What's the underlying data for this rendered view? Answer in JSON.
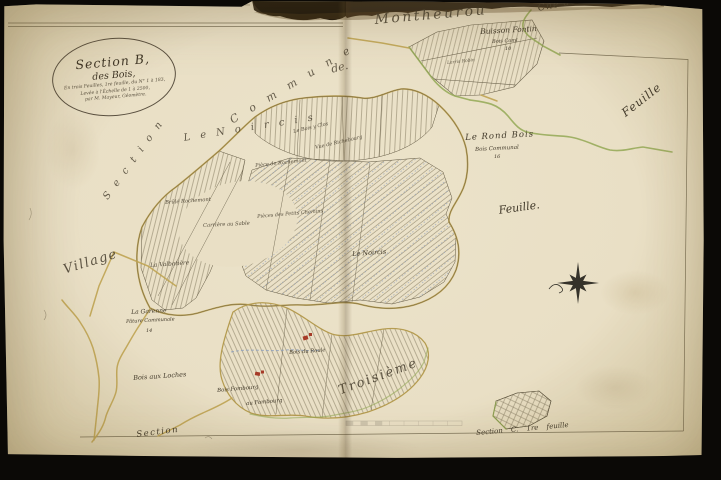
{
  "page": {
    "title": "Section B. des Bois — plan cadastral, 1re feuille"
  },
  "cartouche": {
    "line1": "Section B,",
    "line2": "des Bois,",
    "line3": "En trois Feuilles, 1re feuille, du N° 1 à 183,",
    "line4": "Levée à l'Échelle de 1 à 2500,",
    "line5": "par M. Mayeur, Géomètre."
  },
  "border": {
    "commune_spaced": "C o m m u n e",
    "de": "de.",
    "montheurou": "Montheurou",
    "cne_crise": "Cne de Crise",
    "section_left": "S e c t i o n",
    "village": "Village",
    "section_bottom": "Section",
    "troisieme": "Troisième",
    "noircis_stretched": "L e  N o i r c i s"
  },
  "places": {
    "buisson_fontin": "Buisson Fontin",
    "buisson_fontin_sub": "Bois Coml",
    "buisson_fontin_num": "10",
    "larris_robin": "Larris Robin",
    "feuille_right": "Feuille",
    "rond_bois": "Le Rond Bois",
    "rond_bois_sub": "Bois Communal",
    "rond_bois_num": "16",
    "feuille_center": "Feuille.",
    "noircis_small": "Le Noircis",
    "bois_y_clos": "Le Bois y Clos",
    "richebourg": "Vue de Richebourg",
    "rochemont_piece": "Pièce de Rochemont",
    "petits_chemins": "Pièces des Petits Chemins",
    "brule_rochemont": "Brûlé Rochemont",
    "carriere_sable": "Carrière au Sable",
    "valbotiere": "La Valbotière",
    "garenne": "La Garenne",
    "garenne_sub": "Pâture Communale",
    "garenne_num": "14",
    "bois_loches": "Bois aux Loches",
    "bois_roule": "Bois du Roule",
    "bois_fombourg": "Bois Fombourg",
    "au_fombourg": "au Fombourg",
    "section_c": "Section C.  1re feuille"
  },
  "colors": {
    "paper": "#e9dfc5",
    "ink": "#41392a",
    "road_ochre": "#bfa452",
    "boundary_green": "#93a854",
    "water_blue": "#8fa0bd",
    "building_red": "#a63b28"
  }
}
